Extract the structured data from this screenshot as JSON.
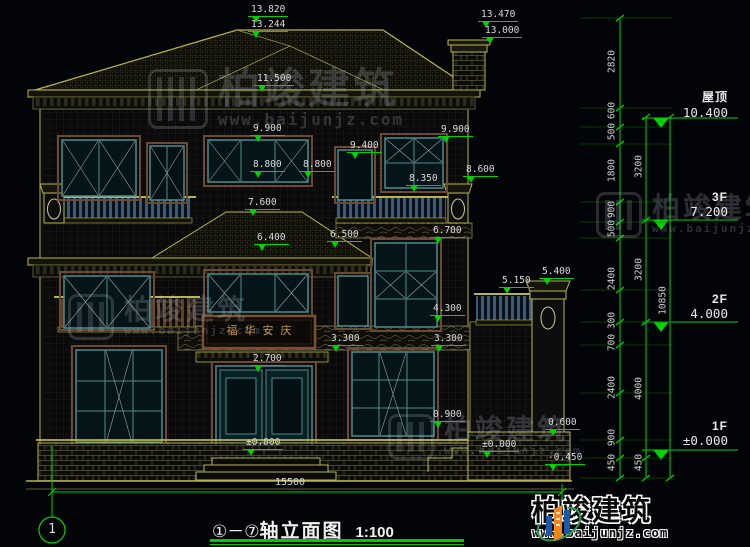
{
  "drawing": {
    "title_axis": "①－⑦",
    "title_name": "轴立面图",
    "title_scale": "1:100",
    "axis_bubble": "1",
    "bottom_dim": "15500",
    "plaque_text": "福华安庆",
    "levels": [
      "13.820",
      "13.244",
      "13.470",
      "13.000",
      "11.500",
      "9.900",
      "9.900",
      "9.400",
      "8.800",
      "8.800",
      "8.600",
      "8.350",
      "7.600",
      "6.400",
      "6.500",
      "6.700",
      "5.400",
      "5.150",
      "4.300",
      "3.300",
      "3.300",
      "2.700",
      "0.900",
      "0.600",
      "±0.000",
      "±0.000",
      "-0.450"
    ],
    "floors": [
      {
        "label": "屋顶",
        "value": "10.400"
      },
      {
        "label": "3F",
        "value": "7.200"
      },
      {
        "label": "2F",
        "value": "4.000"
      },
      {
        "label": "1F",
        "value": "±0.000"
      }
    ],
    "vdims_col1": [
      "2820",
      "600",
      "500",
      "1800",
      "900",
      "500",
      "2400",
      "300",
      "700",
      "2400",
      "900",
      "450"
    ],
    "vdims_col2": [
      "3200",
      "3200",
      "4000",
      "450"
    ],
    "vdims_col3": [
      "10850"
    ]
  },
  "watermark": {
    "name": "柏竣建筑",
    "url": "www.baijunjz.com"
  },
  "brand": {
    "name": "柏竣建筑",
    "url": "www.baijunjz.com"
  },
  "colors": {
    "line_yellow": "#b9b54b",
    "dim_green": "#00d400",
    "frame_teal": "#4e8c8c",
    "brand_blue": "#1d57a8",
    "brand_orange": "#f08519"
  }
}
